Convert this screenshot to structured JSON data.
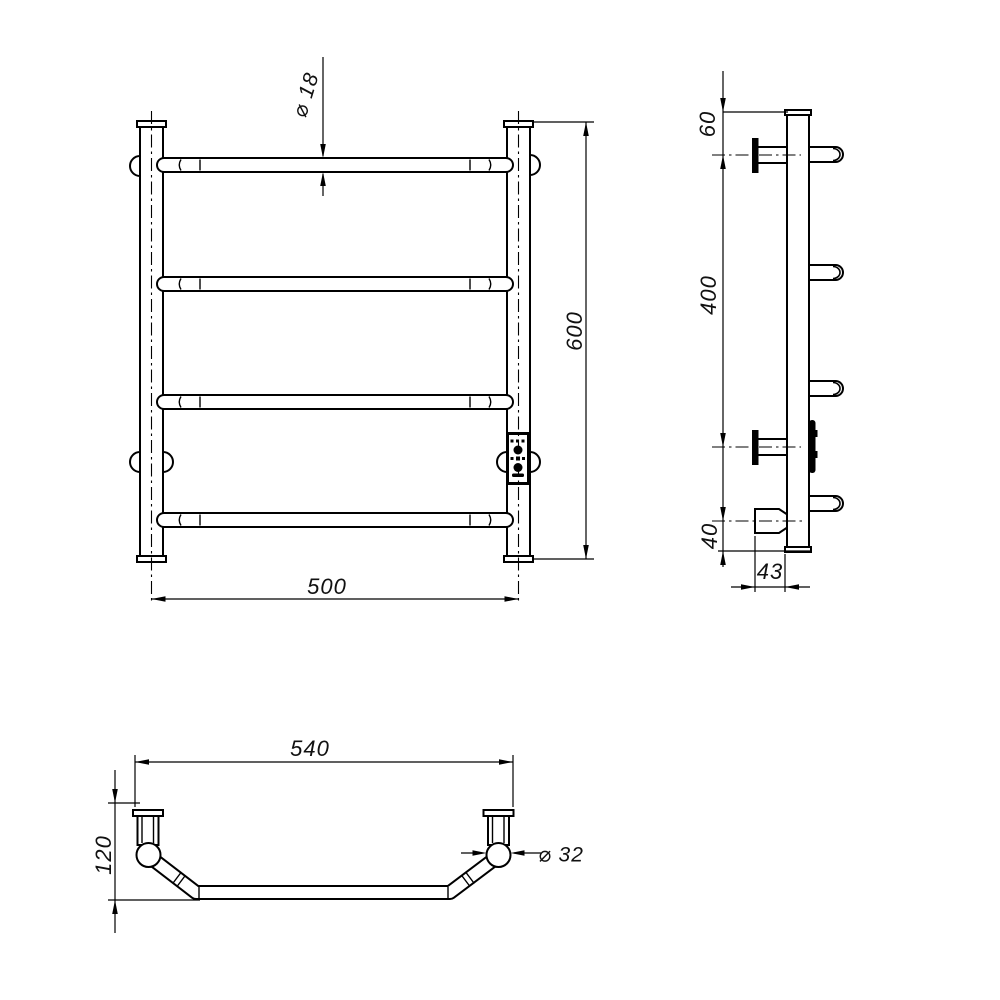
{
  "drawing": {
    "kind": "technical-drawing",
    "subject": "wall-mounted electric towel rail, 4 bars, with control unit",
    "views": [
      "front",
      "side",
      "bottom"
    ]
  },
  "dims": {
    "front": {
      "bar_diameter": "⌀ 18",
      "height": "600",
      "width": "500"
    },
    "side": {
      "top_offset": "60",
      "bracket_span": "400",
      "bottom_offset": "40",
      "depth_offset": "43"
    },
    "bottom": {
      "overall_width": "540",
      "depth": "120",
      "post_diameter": "⌀ 32"
    }
  }
}
